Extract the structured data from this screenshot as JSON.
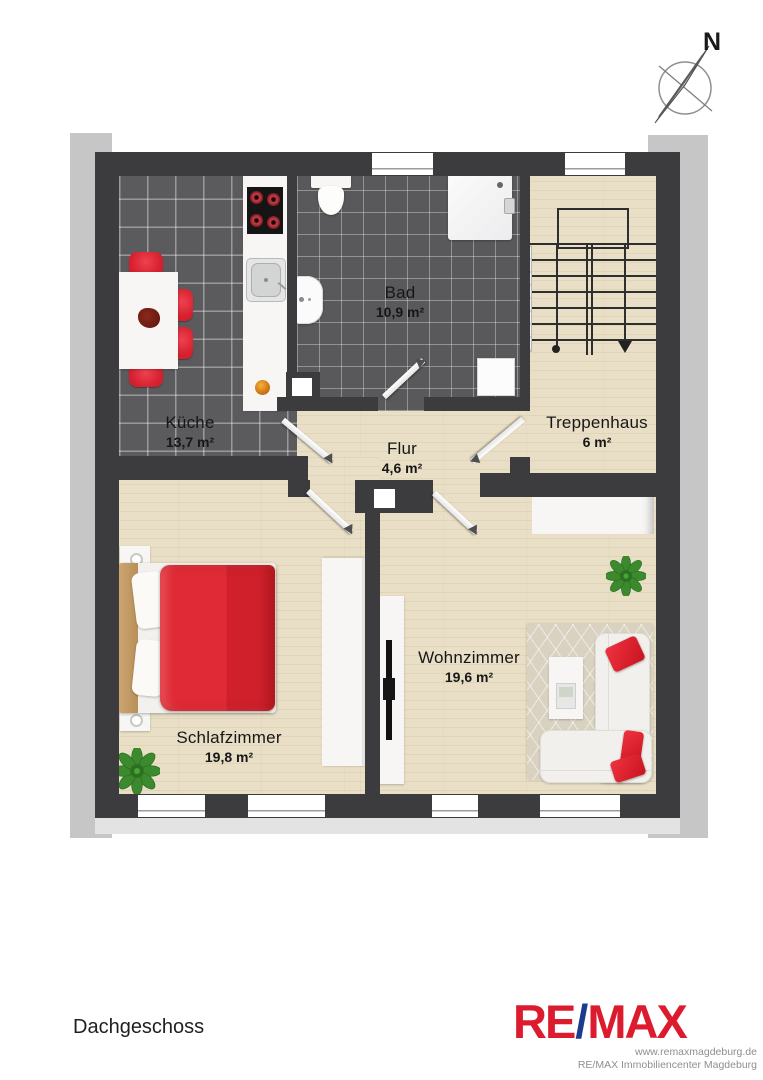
{
  "plan": {
    "rooms": [
      {
        "id": "kueche",
        "name": "Küche",
        "area": "13,7 m²"
      },
      {
        "id": "bad",
        "name": "Bad",
        "area": "10,9 m²"
      },
      {
        "id": "treppenhaus",
        "name": "Treppenhaus",
        "area": "6 m²"
      },
      {
        "id": "flur",
        "name": "Flur",
        "area": "4,6 m²"
      },
      {
        "id": "schlafzimmer",
        "name": "Schlafzimmer",
        "area": "19,8 m²"
      },
      {
        "id": "wohnzimmer",
        "name": "Wohnzimmer",
        "area": "19,6 m²"
      }
    ],
    "compass": {
      "north_label": "N"
    }
  },
  "footer": {
    "floor_label": "Dachgeschoss",
    "logo": {
      "part1": "RE",
      "slash": "/",
      "part2": "MAX"
    },
    "website": "www.remaxmagdeburg.de",
    "company": "RE/MAX Immobiliencenter Magdeburg"
  },
  "colors": {
    "wall": "#3c3c3e",
    "wood": "#e9dfc6",
    "tile": "#5b5b5d",
    "roof_gray": "#c6c6c6",
    "accent_red": "#d8242f",
    "remax_red": "#dc1c2e",
    "remax_blue": "#1d3c8f"
  }
}
